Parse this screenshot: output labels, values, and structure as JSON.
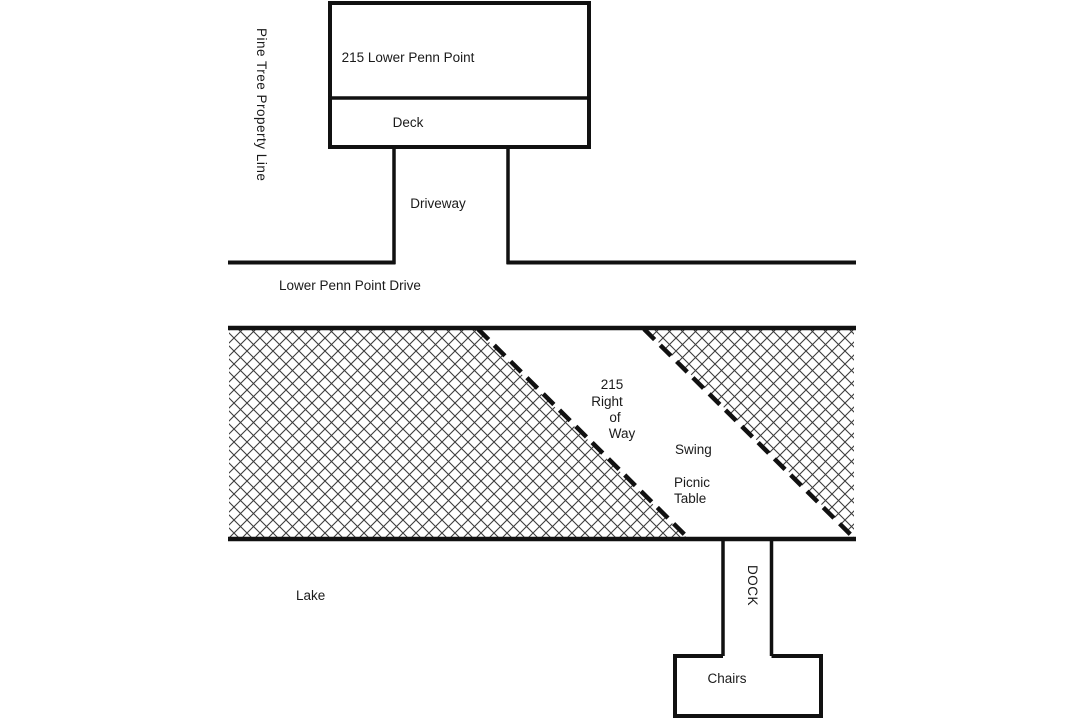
{
  "diagram": {
    "title": "Property sketch of 215 Lower Penn Point",
    "labels": {
      "property_line": "Pine Tree Property Line",
      "house": "215 Lower Penn Point",
      "deck": "Deck",
      "driveway": "Driveway",
      "road": "Lower Penn Point Drive",
      "right_of_way_lines": [
        "215",
        "Right",
        "of",
        "Way"
      ],
      "swing": "Swing",
      "picnic_table": "Picnic\nTable",
      "lake": "Lake",
      "dock": "DOCK",
      "chairs": "Chairs"
    },
    "colors": {
      "line": "#111111",
      "hatch": "#3d3d3d",
      "background": "#ffffff"
    }
  }
}
